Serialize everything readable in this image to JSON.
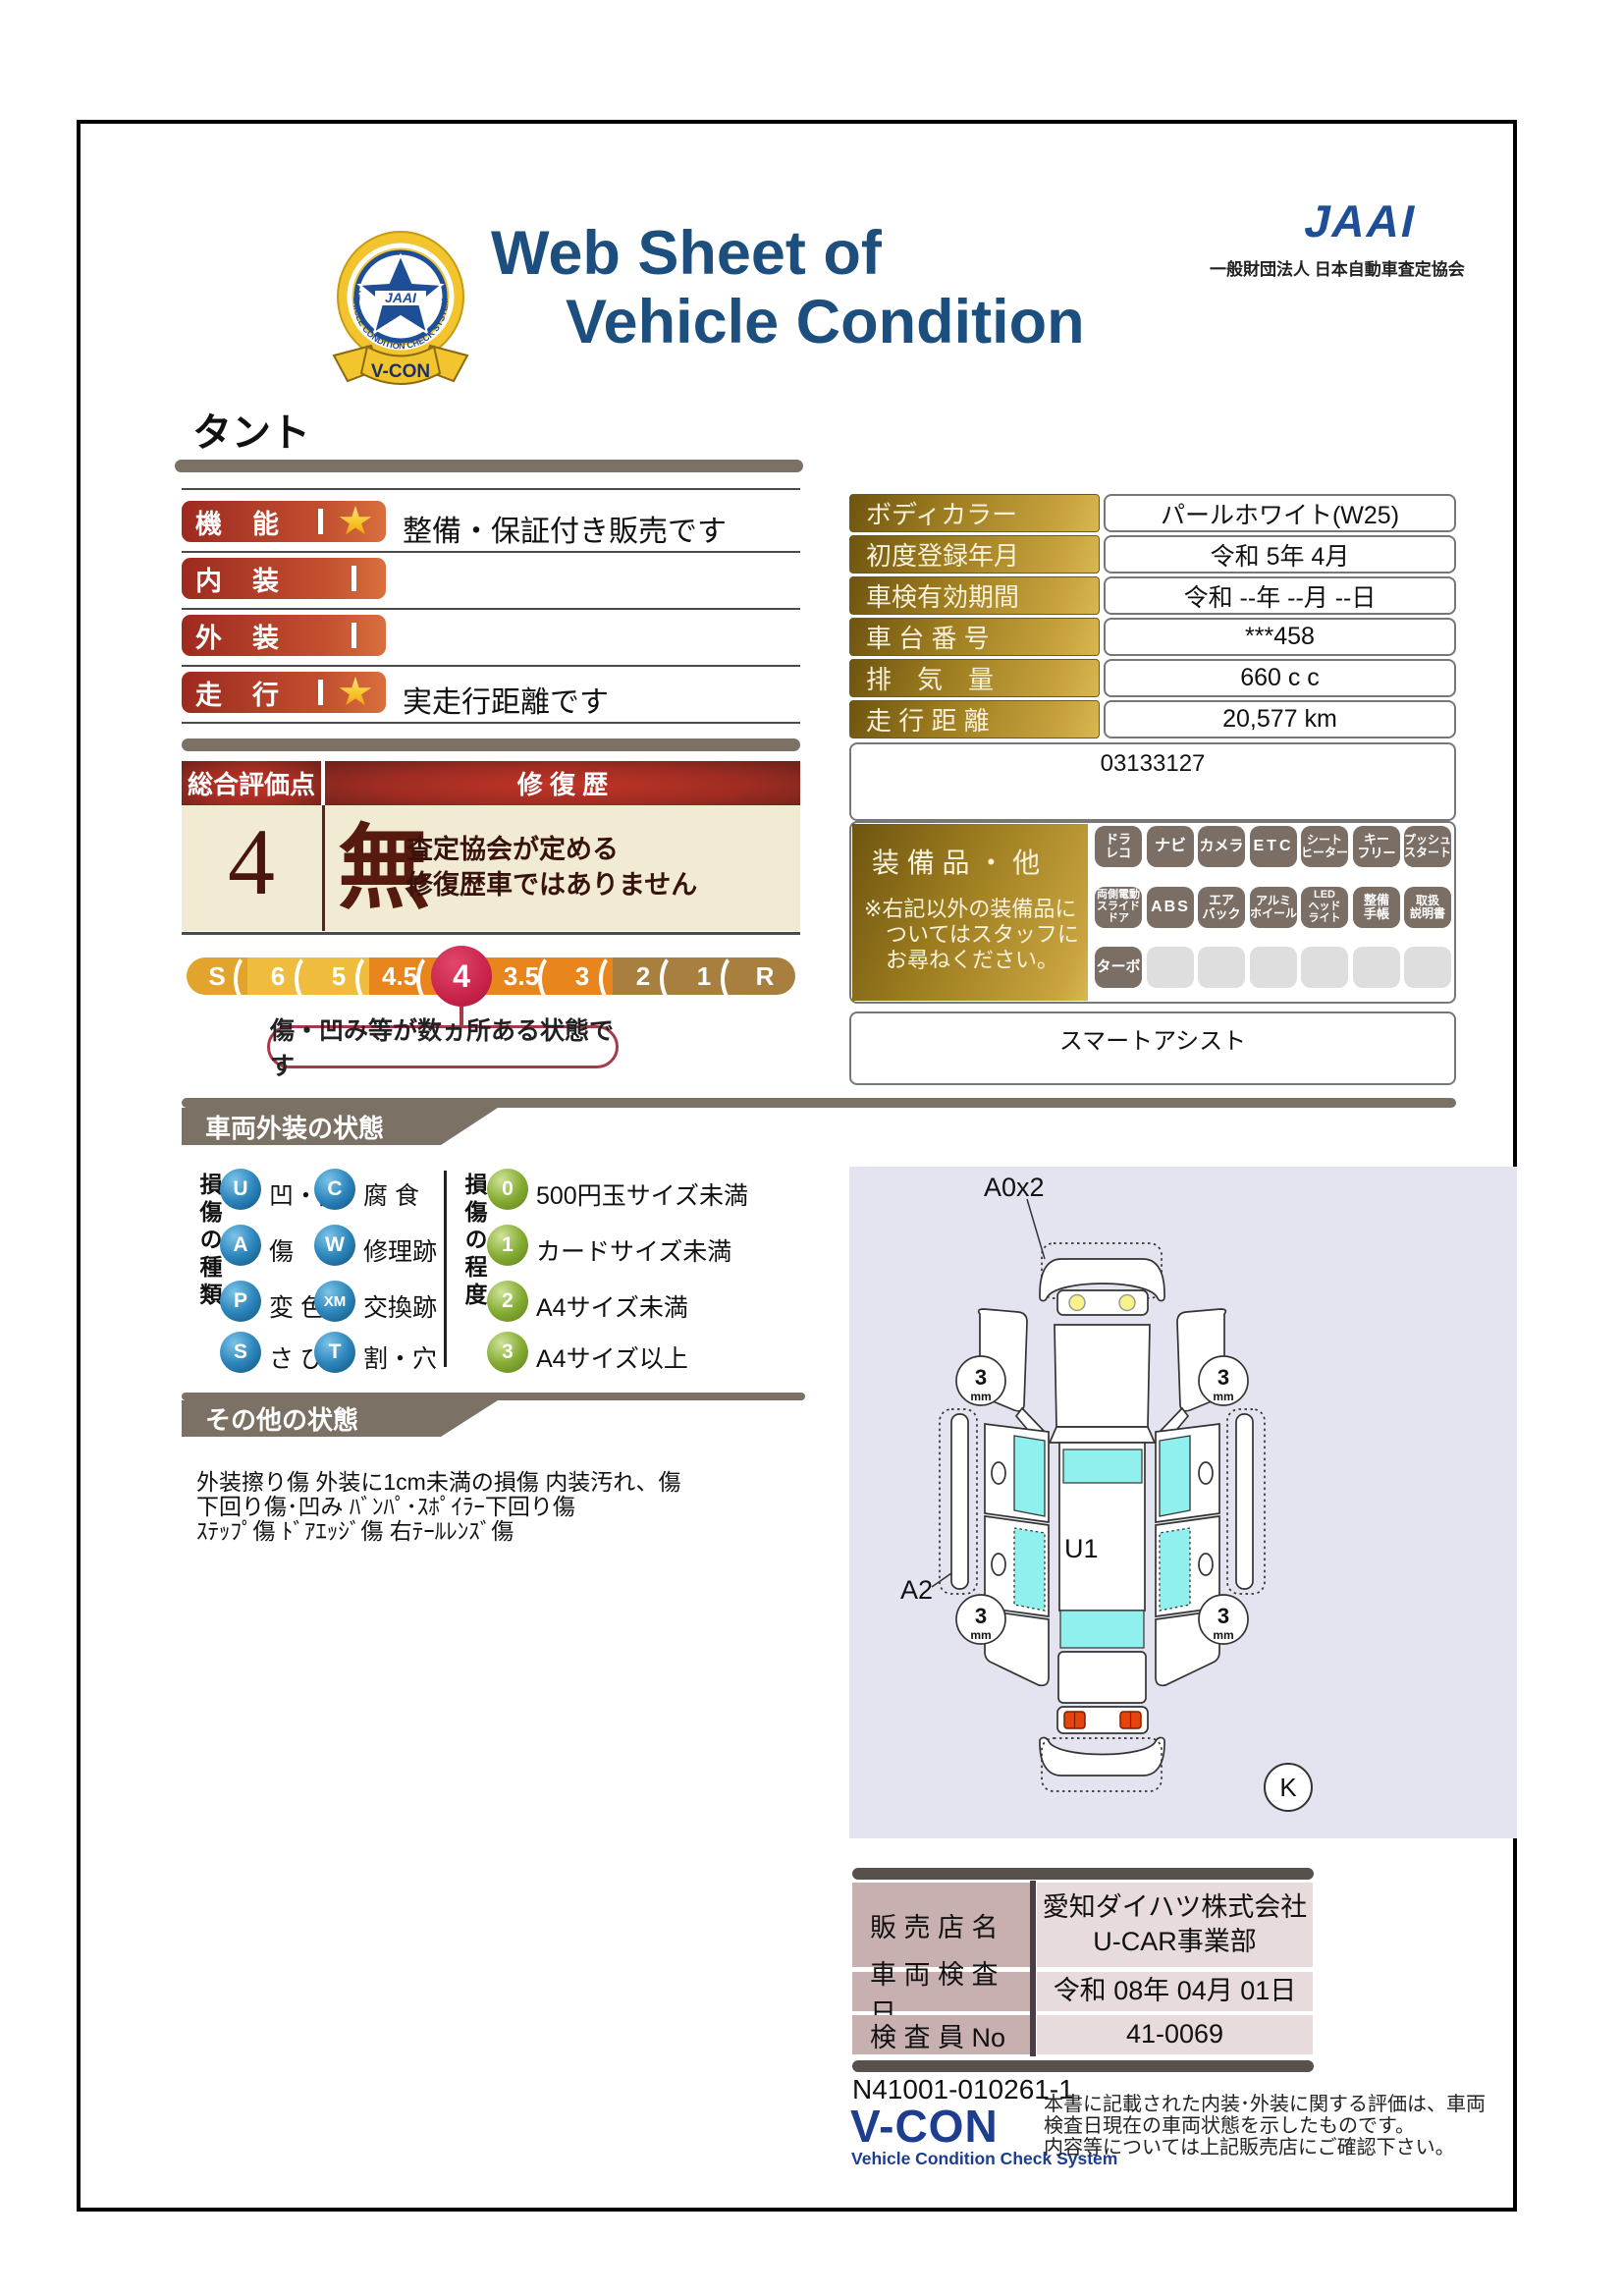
{
  "colors": {
    "title_navy": "#1C4E7E",
    "jaai_blue": "#1E4E96",
    "bar_gray": "#7B7164",
    "pill_red_left": "#9E2A20",
    "pill_red_right": "#D96F3E",
    "cream": "#F2EBD4",
    "maroon_text": "#571A0E",
    "gold_dark": "#6E5410",
    "gold_light": "#D9B850",
    "scale_gold": "#EFBC3E",
    "scale_orange": "#E8851C",
    "scale_tan": "#A97F3F",
    "selected_red": "#C9234A",
    "badge_gray": "#7A6E65",
    "badge_empty": "#DEDEDE",
    "type_blue": "#2E86BC",
    "level_green": "#85AC33",
    "panel_lavender": "#E4E4F0",
    "window_cyan": "#8FF0EE",
    "dealer_label_pink": "#C8B0B0",
    "dealer_value_pink": "#E7DBDB",
    "vcon_blue": "#1D3D8F"
  },
  "header": {
    "title_line1": "Web Sheet of",
    "title_line2": "Vehicle Condition",
    "jaai_logo": "JAAI",
    "jaai_org": "一般財団法人 日本自動車査定協会",
    "badge_center": "JAAI",
    "badge_ring": "VEHICLE CONDITION CHECK SYSTEM",
    "badge_ribbon": "V-CON"
  },
  "vehicle_name": "タント",
  "ratings": {
    "rows": [
      {
        "label": "機　能",
        "starred": true,
        "note": "整備・保証付き販売です"
      },
      {
        "label": "内　装",
        "starred": false,
        "note": ""
      },
      {
        "label": "外　装",
        "starred": false,
        "note": ""
      },
      {
        "label": "走　行",
        "starred": true,
        "note": "実走行距離です"
      }
    ]
  },
  "overall": {
    "score_header": "総合評価点",
    "score": "4",
    "repair_header": "修 復 歴",
    "repair_value": "無",
    "repair_note_line1": "査定協会が定める",
    "repair_note_line2": "修復歴車ではありません"
  },
  "scale": {
    "labels": [
      "S",
      "6",
      "5",
      "4.5",
      "4",
      "3.5",
      "3",
      "2",
      "1",
      "R"
    ],
    "selected": "4",
    "balloon": "傷・凹み等が数ヵ所ある状態です"
  },
  "info": {
    "rows": [
      {
        "label": "ボディカラー",
        "value": "パールホワイト(W25)"
      },
      {
        "label": "初度登録年月",
        "value": "令和 5年 4月"
      },
      {
        "label": "車検有効期間",
        "value": "令和 --年 --月 --日"
      },
      {
        "label": "車 台 番 号",
        "value": "***458"
      },
      {
        "label": "排　気　量",
        "value": "660 c c"
      },
      {
        "label": "走 行 距 離",
        "value": "20,577 km"
      }
    ],
    "ref_number": "03133127"
  },
  "equipment": {
    "header": "装 備 品 ・ 他",
    "note_line1": "※右記以外の装備品に",
    "note_line2": "　ついてはスタッフに",
    "note_line3": "　お尋ねください。",
    "badges": [
      {
        "lines": [
          "ドラ",
          "レコ"
        ]
      },
      {
        "lines": [
          "ナビ"
        ]
      },
      {
        "lines": [
          "カメラ"
        ]
      },
      {
        "lines": [
          "ETC"
        ]
      },
      {
        "lines": [
          "シート",
          "ヒーター"
        ]
      },
      {
        "lines": [
          "キー",
          "フリー"
        ]
      },
      {
        "lines": [
          "プッシュ",
          "スタート"
        ]
      },
      {
        "lines": [
          "両側電動",
          "スライド",
          "ドア"
        ]
      },
      {
        "lines": [
          "ABS"
        ]
      },
      {
        "lines": [
          "エア",
          "バック"
        ]
      },
      {
        "lines": [
          "アルミ",
          "ホイール"
        ]
      },
      {
        "lines": [
          "LED",
          "ヘッド",
          "ライト"
        ]
      },
      {
        "lines": [
          "整備",
          "手帳"
        ]
      },
      {
        "lines": [
          "取扱",
          "説明書"
        ]
      },
      {
        "lines": [
          "ターボ"
        ]
      }
    ],
    "footer": "スマートアシスト"
  },
  "exterior": {
    "title": "車両外装の状態",
    "type_header": "損傷の種類",
    "types": [
      {
        "code": "U",
        "label": "凹・曲"
      },
      {
        "code": "C",
        "label": "腐 食"
      },
      {
        "code": "A",
        "label": "傷"
      },
      {
        "code": "W",
        "label": "修理跡"
      },
      {
        "code": "P",
        "label": "変 色"
      },
      {
        "code": "XM",
        "label": "交換跡"
      },
      {
        "code": "S",
        "label": "さ び"
      },
      {
        "code": "T",
        "label": "割・穴"
      }
    ],
    "level_header": "損傷の程度",
    "levels": [
      {
        "code": "0",
        "label": "500円玉サイズ未満"
      },
      {
        "code": "1",
        "label": "カードサイズ未満"
      },
      {
        "code": "2",
        "label": "A4サイズ未満"
      },
      {
        "code": "3",
        "label": "A4サイズ以上"
      }
    ]
  },
  "other": {
    "title": "その他の状態",
    "line1": "外装擦り傷 外装に1cm未満の損傷 内装汚れ、傷",
    "line2": "下回り傷･凹み ﾊﾞﾝﾊﾟ･ｽﾎﾟｲﾗｰ下回り傷",
    "line3": "ｽﾃｯﾌﾟ傷 ﾄﾞｱｴｯｼﾞ傷 右ﾃｰﾙﾚﾝｽﾞ傷"
  },
  "diagram": {
    "front_label": "A0x2",
    "roof_label": "U1",
    "side_label": "A2",
    "corner_label": "K",
    "tread": "3",
    "tread_unit": "mm"
  },
  "dealer": {
    "rows": [
      {
        "label": "販 売 店 名",
        "value": "愛知ダイハツ株式会社",
        "value2": "U-CAR事業部"
      },
      {
        "label": "車 両 検 査 日",
        "value": "令和 08年 04月 01日"
      },
      {
        "label": "検 査 員 No",
        "value": "41-0069"
      }
    ]
  },
  "footer": {
    "doc_number": "N41001-010261-1",
    "logo": "V-CON",
    "logo_sub": "Vehicle Condition Check System",
    "disclaimer1": "本書に記載された内装･外装に関する評価は、車両",
    "disclaimer2": "検査日現在の車両状態を示したものです。",
    "disclaimer3": "内容等については上記販売店にご確認下さい。"
  }
}
